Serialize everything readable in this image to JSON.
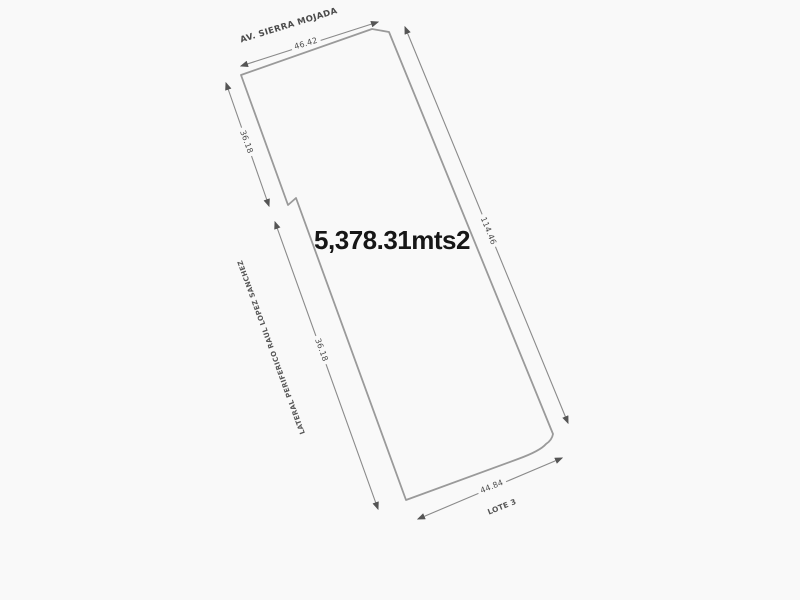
{
  "diagram": {
    "type": "land-survey-plot",
    "area_label": "5,378.31mts2",
    "streets": {
      "top": "AV. SIERRA MOJADA",
      "left": "LATERAL PERIFERICO RAUL LOPEZ SANCHEZ"
    },
    "adjacent_lot": "LOTE 3",
    "dimensions": {
      "top": "46.42",
      "upper_left": "36.18",
      "lower_left": "36.18",
      "right": "114.46",
      "bottom": "44.84"
    },
    "colors": {
      "background": "#f9f9f9",
      "boundary_line": "#9a9a9a",
      "dimension_line": "#8a8a8a",
      "label_text": "#4f4f4f",
      "area_text": "#161616"
    }
  }
}
